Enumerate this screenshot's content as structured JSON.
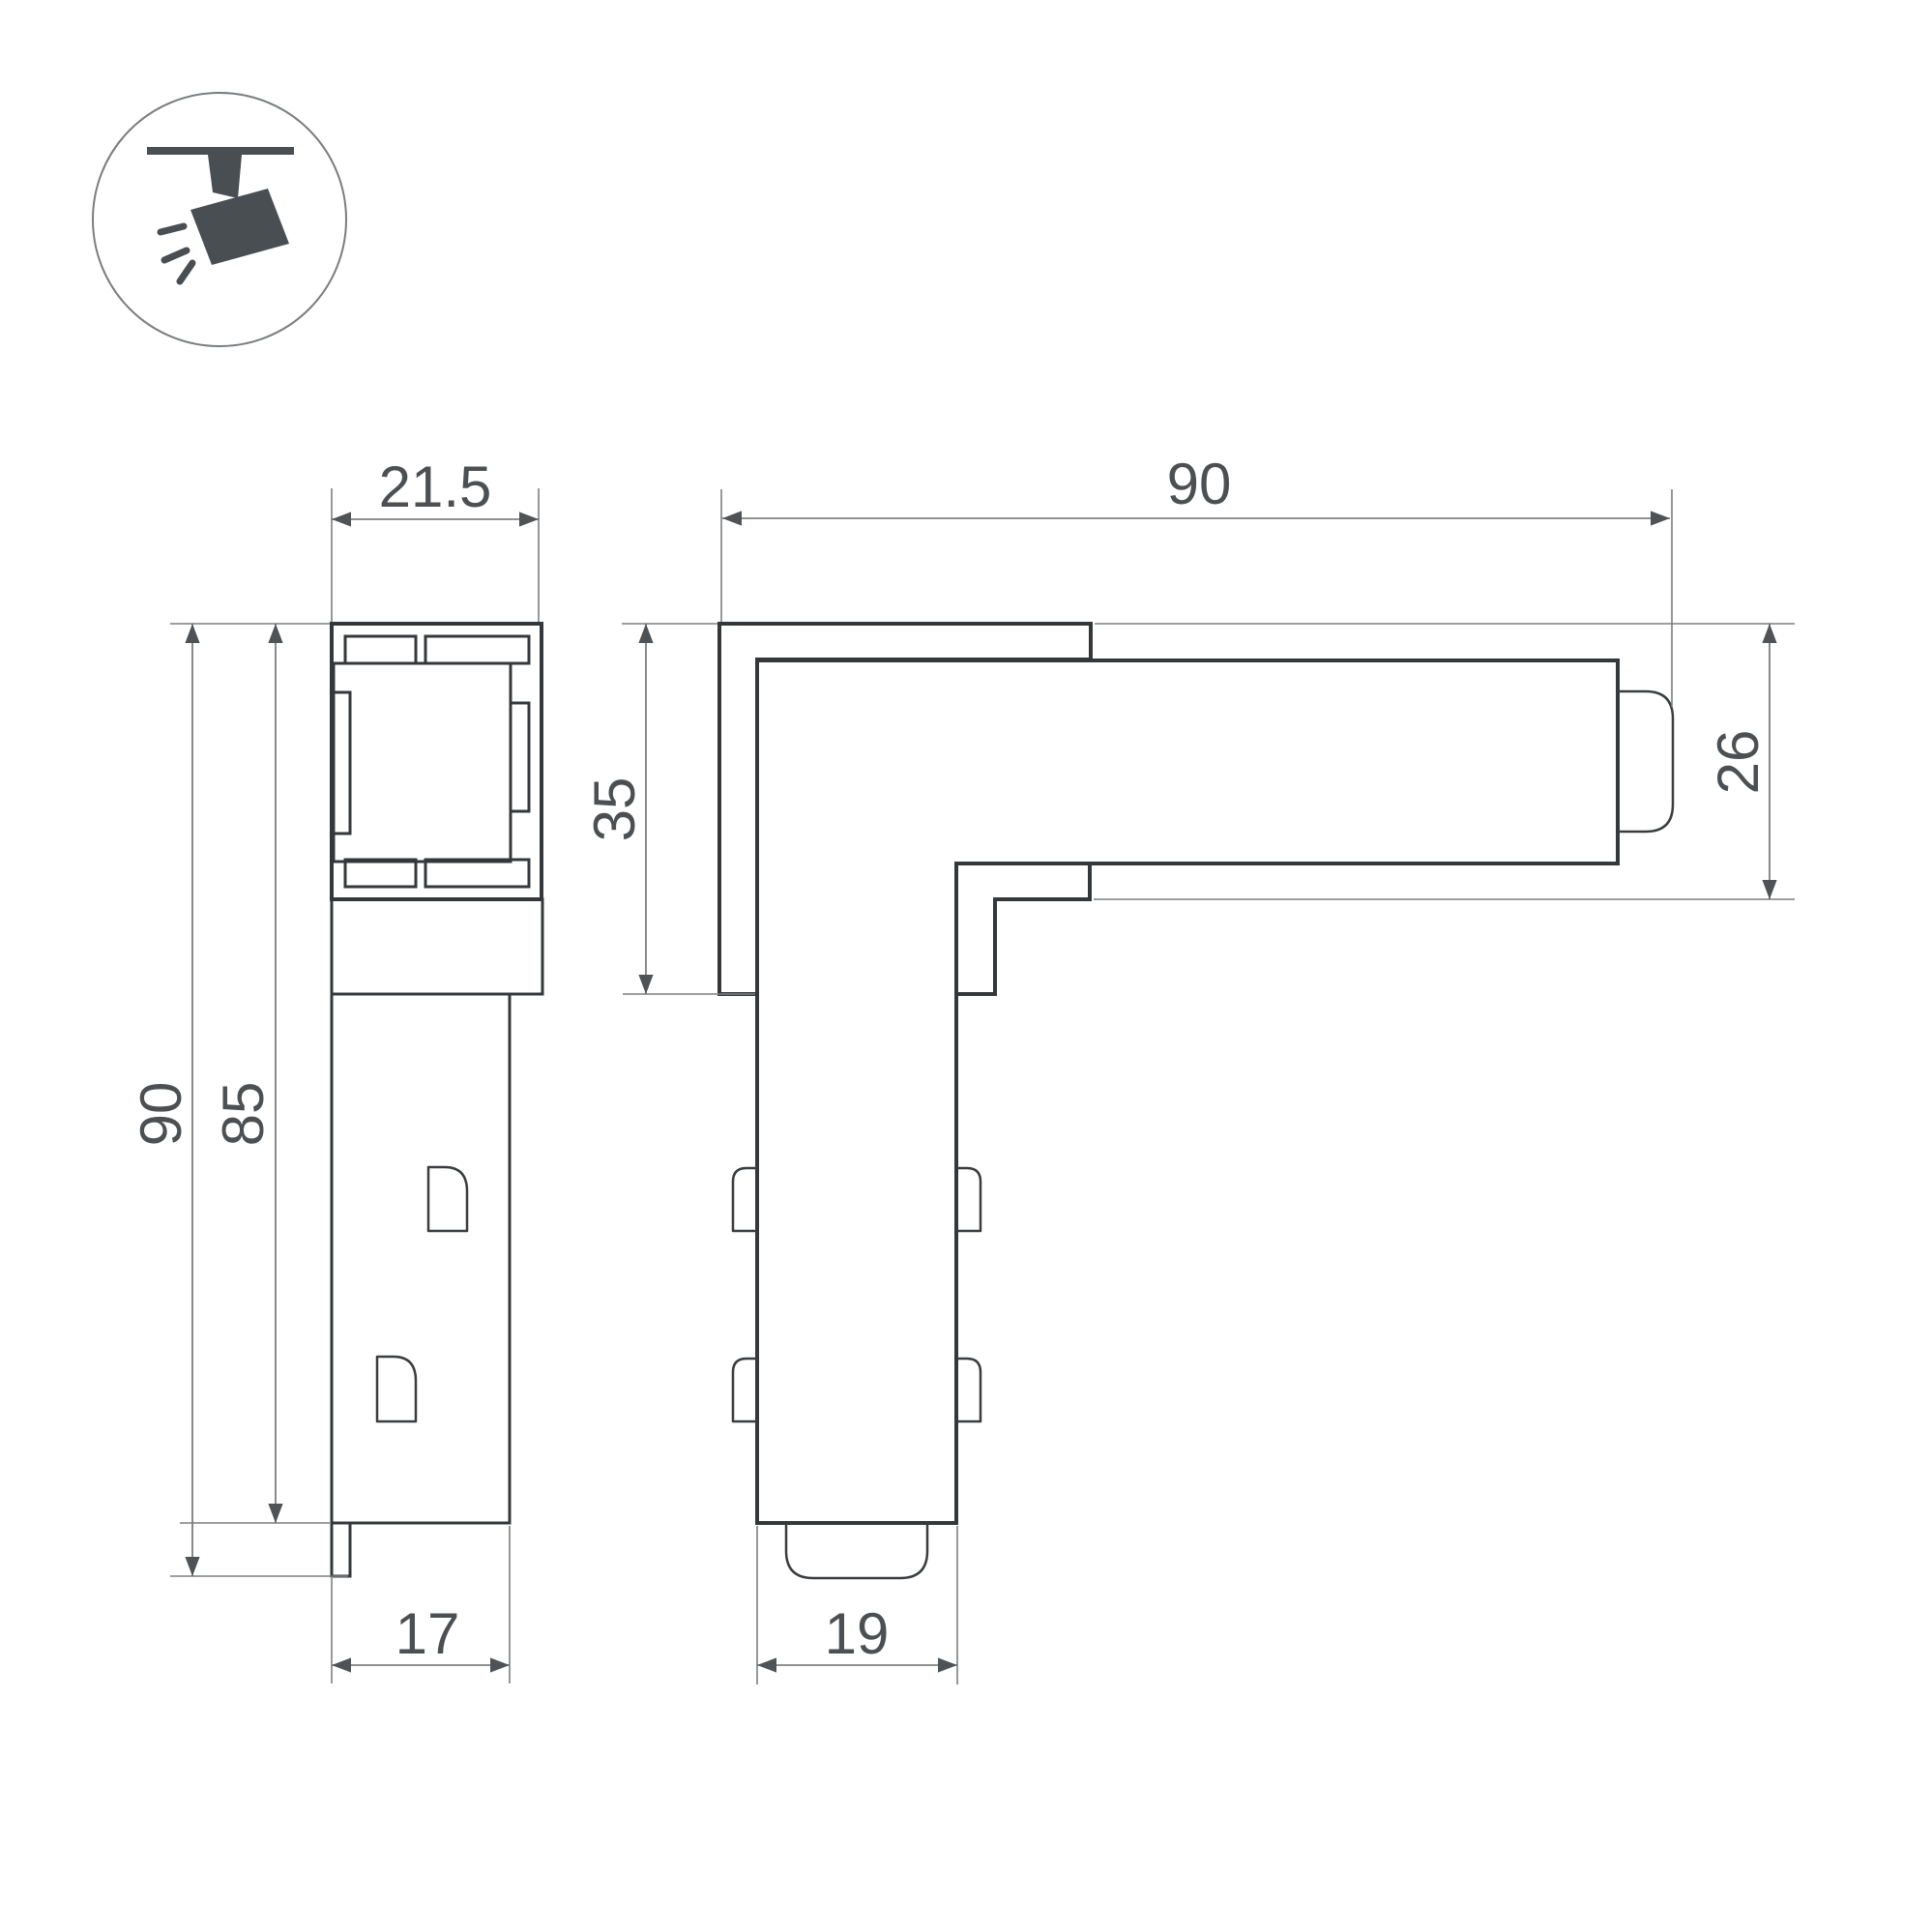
{
  "drawing": {
    "type": "technical-dimension-drawing",
    "product": "L-shaped track corner connector, two orthographic views"
  },
  "icon": {
    "name": "track-spotlight-icon",
    "shapes": [
      "ceiling-line",
      "mount-stem",
      "spotlight-body",
      "light-rays"
    ]
  },
  "colors": {
    "background": "#ffffff",
    "part_outline": "#35383b",
    "dimension_lines": "#6a6d70",
    "dimension_text": "#4d5052",
    "icon": "#494e53"
  },
  "side_view": {
    "name": "side profile view",
    "dimensions": {
      "top_width": "21.5",
      "total_height": "90",
      "body_height": "85",
      "bottom_width": "17"
    }
  },
  "front_view": {
    "name": "corner L view",
    "dimensions": {
      "total_length": "90",
      "corner_height": "35",
      "profile_height": "26",
      "arm_width": "19"
    }
  }
}
